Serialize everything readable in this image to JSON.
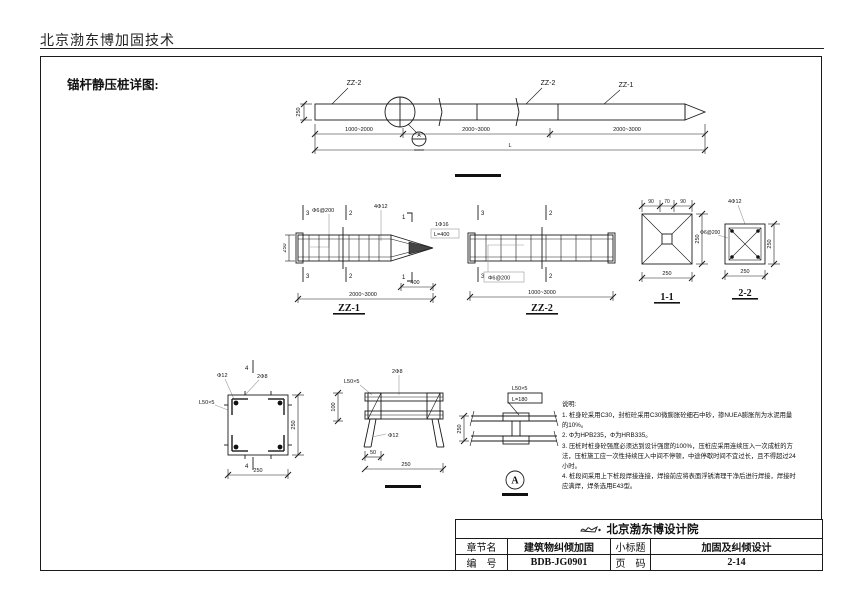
{
  "header": {
    "company": "北京渤东博加固技术"
  },
  "drawing": {
    "title": "锚杆静压桩详图:"
  },
  "elevation": {
    "label_left": "ZZ-2",
    "label_mid": "ZZ-2",
    "label_right": "ZZ-1",
    "dim_height": "250",
    "dim_seg1": "1000~2000",
    "dim_seg2": "2000~3000",
    "dim_seg3": "2000~3000",
    "dim_total": "L",
    "weld_mark": "A"
  },
  "zz1": {
    "title": "ZZ-1",
    "mark3": "3",
    "mark2": "2",
    "mark1": "1",
    "stirrup": "Φ6@200",
    "main_bar": "4Φ12",
    "tip_bar": "1Φ16",
    "tip_len": "L=400",
    "dim_tip": "400",
    "dim_len": "2000~3000",
    "dim_height": "250"
  },
  "zz2": {
    "title": "ZZ-2",
    "mark3": "3",
    "mark2": "2",
    "stirrup": "Φ6@200",
    "dim_len": "1000~3000"
  },
  "sec11": {
    "title": "1-1",
    "dim_a": "90",
    "dim_b": "70",
    "dim_c": "90",
    "dim_right": "250",
    "dim_bottom": "250"
  },
  "sec22": {
    "title": "2-2",
    "main_bar": "4Φ12",
    "stirrup": "Φ6@200",
    "dim_right": "250",
    "dim_bottom": "250"
  },
  "det4": {
    "mark": "4",
    "bar_corner": "Φ12",
    "bar_tie": "2Φ8",
    "angle": "L50×5",
    "dim_right": "250",
    "dim_bottom": "250"
  },
  "det_mid": {
    "angle": "L50×5",
    "bar_tie": "2Φ8",
    "bar_leg": "Φ12",
    "dim_left": "100",
    "dim_a": "50",
    "dim_b": "250"
  },
  "det_a": {
    "angle": "L50×5",
    "length": "L=180",
    "dim_left": "250",
    "mark": "A"
  },
  "notes": {
    "title": "说明:",
    "items": [
      "1. 桩身砼采用C30，封桩砼采用C30微膨胀砼细石中砂，掺NUEA膨胀剂为水泥用量的10%。",
      "2. Φ为HPB235，Φ为HRB335。",
      "3. 压桩时桩身砼强度必须达到设计强度的100%，压桩应采用连续压入一次成桩的方法，压桩施工应一次性持续压入中间不停顿，中途停歇时间不宜过长，且不得超过24小时。",
      "4. 桩段间采用上下桩段焊接连接，焊接前应将表面浮锈清理干净后进行焊接，焊接时应满焊，焊条选用E43型。"
    ]
  },
  "titleblock": {
    "institute": "北京渤东博设计院",
    "row1_k1": "章节名",
    "row1_v1": "建筑物纠倾加固",
    "row1_k2": "小标题",
    "row1_v2": "加固及纠倾设计",
    "row2_k1": "编　号",
    "row2_v1": "BDB-JG0901",
    "row2_k2": "页　码",
    "row2_v2": "2-14"
  }
}
